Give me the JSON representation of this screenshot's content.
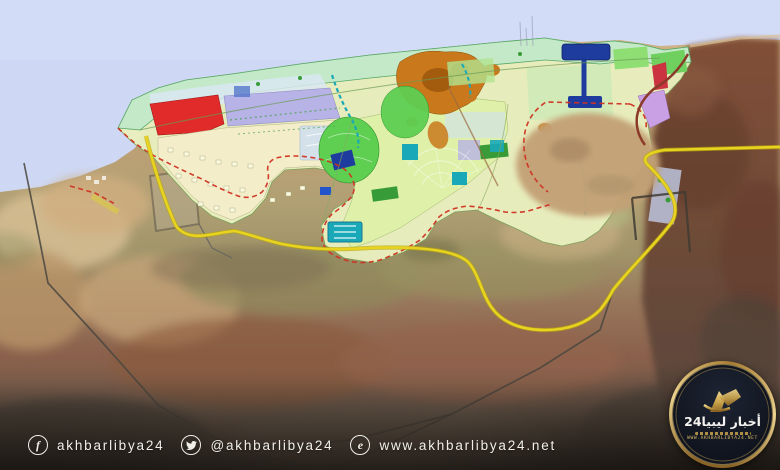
{
  "watermark_bar": {
    "facebook_handle": "akhbarlibya24",
    "twitter_handle": "@akhbarlibya24",
    "website_url": "www.akhbarlibya24.net",
    "facebook_icon_glyph": "f",
    "web_icon_glyph": "e"
  },
  "logo": {
    "title_ar": "أخبار ليبيا24",
    "website": "WWW.AKHBARLIBYA24.NET"
  },
  "colors": {
    "sea": "#ced8f4",
    "sand": "#c2a176",
    "planbase": "#e9efbf",
    "mint": "#c3e9c8",
    "lagoon": "#d9e8f2",
    "zonered": "#e12a2a",
    "lavender": "#b7b3e6",
    "cream": "#f3edca",
    "lightgreen": "#dff0a8",
    "orange": "#c9791c",
    "orangedark": "#a35c0e",
    "park": "#5fcf52",
    "parkdark": "#379c37",
    "teal": "#18a8b8",
    "navy": "#1e3c9e",
    "purple": "#c9a0e4",
    "crimson": "#cc3340",
    "paleblue": "#cfe0f0",
    "roadyellow": "#e8d321",
    "boundaryred": "#cf3322",
    "ringbrown": "#8b3a2a",
    "graybound": "#4a463f",
    "gold": "#c9a24a",
    "goldlight": "#ecd38e",
    "golddeep": "#8a6426",
    "logobg": "#10141e",
    "textlight": "#f1eee8"
  }
}
